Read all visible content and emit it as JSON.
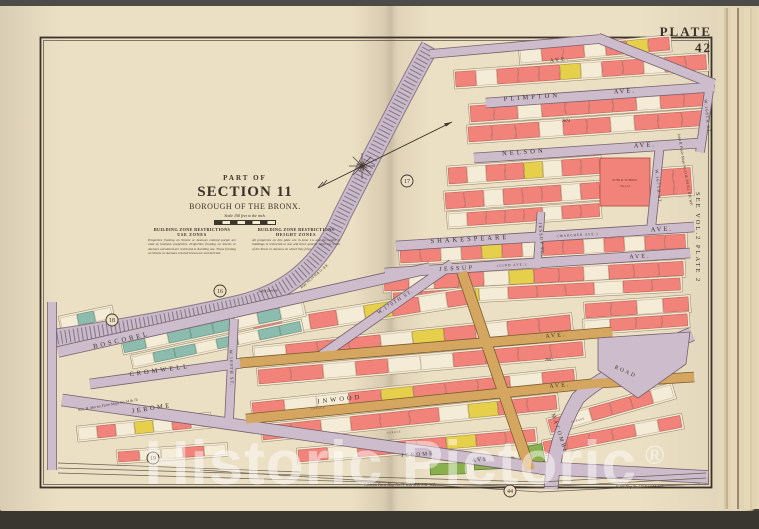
{
  "page": {
    "plate_label": "PLATE 42",
    "side_ref": "SEE VOL.2 PLATE 2",
    "title": {
      "part_of": "PART OF",
      "section": "SECTION 11",
      "borough": "BOROUGH OF THE BRONX.",
      "scale_note": "Scale 100 feet to the inch."
    },
    "zone_notes": [
      {
        "heading": "BUILDING ZONE RESTRICTIONS",
        "sub": "USE ZONES",
        "body": "Properties fronting on Streets or Avenues colored purple are used as business properties. Properties fronting on Streets or Avenues uncolored are restricted to dwelling use. Those fronting on Streets or Avenues colored brown are unrestricted."
      },
      {
        "heading": "BUILDING ZONE RESTRICTIONS",
        "sub": "HEIGHT ZONES",
        "body": "All properties on this plate are in zone 1¾ and the height of buildings is restricted to one and three quarter times the width of the Street or Avenues on which they front."
      }
    ],
    "watermark": {
      "text": "Historic Pictoric",
      "reg": "®"
    }
  },
  "colors": {
    "page": "#ebdfc4",
    "block_face": "#f2e9d3",
    "block_edge": "#8c7a60",
    "street": "#cdbccb",
    "street_edge": "#77606e",
    "tan": "#d4a660",
    "tan_edge": "#7c5c30",
    "rail": "#c9bac9",
    "rail_tie": "#857386",
    "rail_edge": "#8a7888",
    "pink": "#f2837b",
    "pink_edge": "#a84a40",
    "yellow": "#e6cf4a",
    "yellow_edge": "#8a7a28",
    "white": "#f4ecd7",
    "white_edge": "#b3a287",
    "teal": "#8cbcae",
    "teal_edge": "#44766a",
    "green": "#8ab04e",
    "green_edge": "#4c6e2a",
    "ink": "#3b3329",
    "track": "#6b5f55"
  },
  "map": {
    "frame": {
      "x": 40,
      "y": 37,
      "w": 672,
      "h": 451
    },
    "rows": [
      {
        "x": 520,
        "y": 50,
        "w": 150,
        "h": 13,
        "r": -5,
        "cs": "wppwpyp"
      },
      {
        "x": 455,
        "y": 72,
        "w": 252,
        "h": 15,
        "r": -4,
        "cs": "pwpppywppwpp"
      },
      {
        "x": 470,
        "y": 106,
        "w": 238,
        "h": 16,
        "r": -4,
        "cs": "ppwppppwpp"
      },
      {
        "x": 468,
        "y": 127,
        "w": 238,
        "h": 15,
        "r": -4,
        "cs": "pppwppwppp"
      },
      {
        "x": 448,
        "y": 168,
        "w": 152,
        "h": 16,
        "r": -4,
        "cs": "pwppywpp"
      },
      {
        "x": 445,
        "y": 193,
        "w": 155,
        "h": 16,
        "r": -4,
        "cs": "ppwpppwp"
      },
      {
        "x": 448,
        "y": 214,
        "w": 152,
        "h": 13,
        "r": -4,
        "cs": "wppppwpp"
      },
      {
        "x": 655,
        "y": 170,
        "w": 36,
        "h": 26,
        "r": -4,
        "cs": "pp"
      },
      {
        "x": 400,
        "y": 249,
        "w": 286,
        "h": 14,
        "r": -3,
        "cs": "ppwpypwppwpwpp"
      },
      {
        "x": 384,
        "y": 277,
        "w": 300,
        "h": 14,
        "r": -3,
        "cs": "pwppwyppwppp"
      },
      {
        "x": 393,
        "y": 293,
        "w": 288,
        "h": 12,
        "r": -3,
        "cs": "ppywpppwpp"
      },
      {
        "x": 254,
        "y": 323,
        "w": 222,
        "h": 15,
        "r": -9,
        "cs": "pwpwypwp"
      },
      {
        "x": 254,
        "y": 348,
        "w": 318,
        "h": 15,
        "r": -6,
        "cs": "wpppwypwpp"
      },
      {
        "x": 258,
        "y": 370,
        "w": 326,
        "h": 14,
        "r": -5,
        "cs": "ppwpwwpppp"
      },
      {
        "x": 252,
        "y": 403,
        "w": 324,
        "h": 15,
        "r": -6,
        "cs": "pwwpypppwp"
      },
      {
        "x": 262,
        "y": 426,
        "w": 296,
        "h": 14,
        "r": -6,
        "cs": "ppwpppwypp"
      },
      {
        "x": 298,
        "y": 450,
        "w": 238,
        "h": 12,
        "r": -5,
        "cs": "pwpppypp"
      },
      {
        "x": 122,
        "y": 341,
        "w": 184,
        "h": 12,
        "r": -12,
        "cs": "twtttwtw"
      },
      {
        "x": 132,
        "y": 357,
        "w": 172,
        "h": 10,
        "r": -12,
        "cs": "wttwtwtt"
      },
      {
        "x": 60,
        "y": 318,
        "w": 52,
        "h": 11,
        "r": -12,
        "cs": "wtw"
      },
      {
        "x": 78,
        "y": 428,
        "w": 132,
        "h": 12,
        "r": -6,
        "cs": "wpwywpw"
      },
      {
        "x": 118,
        "y": 452,
        "w": 108,
        "h": 10,
        "r": -4,
        "cs": "pwwpw"
      },
      {
        "x": 548,
        "y": 420,
        "w": 128,
        "h": 13,
        "r": -16,
        "cs": "pwpppw"
      },
      {
        "x": 543,
        "y": 442,
        "w": 140,
        "h": 12,
        "r": -11,
        "cs": "ppppwp"
      },
      {
        "x": 585,
        "y": 304,
        "w": 104,
        "h": 14,
        "r": -4,
        "cs": "ppwp"
      },
      {
        "x": 584,
        "y": 321,
        "w": 104,
        "h": 12,
        "r": -4,
        "cs": "wppp"
      }
    ],
    "greens": [
      {
        "x": 430,
        "y": 464,
        "w": 36,
        "h": 11,
        "r": -2
      },
      {
        "x": 474,
        "y": 459,
        "w": 40,
        "h": 11,
        "r": -3
      },
      {
        "x": 528,
        "y": 446,
        "w": 14,
        "h": 18,
        "r": -10
      }
    ],
    "school": {
      "x": 600,
      "y": 158,
      "w": 50,
      "h": 48,
      "label1": "PUBLIC SCHOOL",
      "label2": "No.114"
    },
    "rail": {
      "d": "M430,46 C400,100 365,170 342,215 C322,262 290,292 240,304 C180,318 110,330 56,338"
    },
    "plaza": "598,338 690,332 686,364 638,398 598,370",
    "streets": [
      {
        "d": "M430,54 L600,39",
        "w": 8,
        "k": "st",
        "n": "street-top-boundary"
      },
      {
        "d": "M598,38 L714,84",
        "w": 9,
        "k": "st",
        "n": "street-top-right"
      },
      {
        "d": "M486,103 L714,87",
        "w": 9,
        "k": "st",
        "n": "street-plimpton-ave"
      },
      {
        "d": "M710,84 L700,152",
        "w": 8,
        "k": "st",
        "n": "street-w168th-st"
      },
      {
        "d": "M474,158 L701,143",
        "w": 9,
        "k": "st",
        "n": "street-nelson-ave"
      },
      {
        "d": "M660,144 L651,229",
        "w": 8,
        "k": "st",
        "n": "street-w167th-st"
      },
      {
        "d": "M396,246 L694,227",
        "w": 9,
        "k": "st",
        "n": "street-shakespeare-ave"
      },
      {
        "d": "M385,273 L690,253",
        "w": 9,
        "k": "st",
        "n": "street-jessup-ave"
      },
      {
        "d": "M541,212 L537,268",
        "w": 7,
        "k": "st",
        "n": "street-jessup-pl"
      },
      {
        "d": "M322,355 L452,264",
        "w": 9,
        "k": "st",
        "n": "street-w170th-st"
      },
      {
        "d": "M58,352 L430,268",
        "w": 10,
        "k": "st",
        "n": "street-boscobel-ave"
      },
      {
        "d": "M90,384 L242,363",
        "w": 9,
        "k": "st",
        "n": "street-cromwell-ave"
      },
      {
        "d": "M234,319 L229,421",
        "w": 8,
        "k": "st",
        "n": "street-w169th-st"
      },
      {
        "d": "M52,302 L52,470",
        "w": 8,
        "k": "st",
        "n": "street-left-vertical"
      },
      {
        "d": "M62,400 L540,468",
        "w": 11,
        "k": "st",
        "n": "street-jerome-ave"
      },
      {
        "d": "M540,468 L708,477",
        "w": 12,
        "k": "st",
        "n": "street-jerome-ave-east"
      },
      {
        "d": "M692,334 C640,356 600,378 578,398 C560,428 553,458 551,489",
        "w": 13,
        "k": "st",
        "n": "street-macombs-road"
      },
      {
        "d": "M240,363 L612,332",
        "w": 9,
        "k": "tan",
        "n": "street-cromwell-ave-east"
      },
      {
        "d": "M246,419 L600,383 L694,377",
        "w": 9,
        "k": "tan",
        "n": "street-inwood-ave"
      },
      {
        "d": "M462,272 L530,470",
        "w": 10,
        "k": "tan",
        "n": "street-diagonal-tan"
      }
    ],
    "tracks": [
      "M58,463 L300,472",
      "M58,468 L540,482 L706,473",
      "M58,473 L540,487 L706,478",
      "M200,470 L540,492 L700,484"
    ],
    "labels": [
      {
        "t": "PLIMPTON",
        "x": 532,
        "y": 99,
        "r": -4,
        "s": 6.5,
        "sp": 3
      },
      {
        "t": "AVE.",
        "x": 625,
        "y": 93,
        "r": -4,
        "s": 6.5,
        "sp": 2
      },
      {
        "t": "NELSON",
        "x": 524,
        "y": 154,
        "r": -4,
        "s": 6.5,
        "sp": 3
      },
      {
        "t": "AVE.",
        "x": 645,
        "y": 147,
        "r": -4,
        "s": 6.5,
        "sp": 2
      },
      {
        "t": "SHAKESPEARE",
        "x": 470,
        "y": 241,
        "r": -3,
        "s": 6.5,
        "sp": 3
      },
      {
        "t": "(MARCHER AVE.)",
        "x": 578,
        "y": 236,
        "r": -3,
        "s": 3.4,
        "sp": 1
      },
      {
        "t": "AVE.",
        "x": 662,
        "y": 231,
        "r": -3,
        "s": 6.5,
        "sp": 2
      },
      {
        "t": "JESSUP",
        "x": 457,
        "y": 270,
        "r": -3,
        "s": 6,
        "sp": 2.5
      },
      {
        "t": "(LIND AVE.)",
        "x": 512,
        "y": 266,
        "r": -3,
        "s": 3.4,
        "sp": 1
      },
      {
        "t": "AVE.",
        "x": 640,
        "y": 258,
        "r": -3,
        "s": 6,
        "sp": 2
      },
      {
        "t": "JESSUP PL.",
        "x": 540,
        "y": 240,
        "r": 86,
        "s": 4.6,
        "sp": 1.2
      },
      {
        "t": "W.170TH ST.",
        "x": 396,
        "y": 303,
        "r": -33,
        "s": 5.2,
        "sp": 1.2
      },
      {
        "t": "BOSCOBEL",
        "x": 122,
        "y": 342,
        "r": -13,
        "s": 6.5,
        "sp": 3
      },
      {
        "t": "CROMWELL",
        "x": 160,
        "y": 372,
        "r": -8,
        "s": 6.5,
        "sp": 3
      },
      {
        "t": "AVE.",
        "x": 556,
        "y": 337,
        "r": -5,
        "s": 6,
        "sp": 2
      },
      {
        "t": "W.169TH ST.",
        "x": 230,
        "y": 368,
        "r": 88,
        "s": 4.6,
        "sp": 1
      },
      {
        "t": "INWOOD",
        "x": 340,
        "y": 401,
        "r": -6,
        "s": 6.5,
        "sp": 3
      },
      {
        "t": "AVE.",
        "x": 560,
        "y": 387,
        "r": -5,
        "s": 6,
        "sp": 2
      },
      {
        "t": "JEROME",
        "x": 152,
        "y": 410,
        "r": -9,
        "s": 6.5,
        "sp": 2.5
      },
      {
        "t": "JEROME",
        "x": 418,
        "y": 456,
        "r": -4,
        "s": 5.5,
        "sp": 2
      },
      {
        "t": "AVE.",
        "x": 482,
        "y": 461,
        "r": -4,
        "s": 5.5,
        "sp": 2
      },
      {
        "t": "MACOMBS",
        "x": 558,
        "y": 434,
        "r": 72,
        "s": 5.5,
        "sp": 2
      },
      {
        "t": "ROAD",
        "x": 625,
        "y": 373,
        "r": 24,
        "s": 5.5,
        "sp": 2
      },
      {
        "t": "W.168TH ST.",
        "x": 706,
        "y": 117,
        "r": 84,
        "s": 4.4,
        "sp": 1
      },
      {
        "t": "W.167TH ST.",
        "x": 657,
        "y": 187,
        "r": 84,
        "s": 4.4,
        "sp": 1
      },
      {
        "t": "AVE.",
        "x": 560,
        "y": 61,
        "r": -7,
        "s": 5.5,
        "sp": 2
      }
    ],
    "block_numbers": [
      {
        "t": "2674",
        "x": 566,
        "y": 122
      },
      {
        "t": "2667",
        "x": 549,
        "y": 361
      }
    ],
    "garages": [
      {
        "t": "GARAGE",
        "x": 318,
        "y": 409,
        "r": -6
      },
      {
        "t": "GARAGE",
        "x": 394,
        "y": 433,
        "r": -6
      },
      {
        "t": "GARAGE",
        "x": 578,
        "y": 421,
        "r": -15
      }
    ],
    "notes": [
      {
        "t": "John  Devoe",
        "x": 268,
        "y": 292,
        "r": -3,
        "s": 4.2
      },
      {
        "t": "Rept. No.14  W.& O. R.R.",
        "x": 315,
        "y": 277,
        "r": -41,
        "s": 3.6
      },
      {
        "t": "Wm. H. Morris Farm  Maps No.14 & 74",
        "x": 108,
        "y": 406,
        "r": -10,
        "s": 3.8
      },
      {
        "t": "John R. Poole   Maps No.41 & 391   B.I. F.M. W.F.",
        "x": 684,
        "y": 170,
        "r": 80,
        "s": 3.8
      },
      {
        "t": "Gibbons  Farm    Map No.71   W.& M.B.  S.M.   W.P.",
        "x": 400,
        "y": 486,
        "r": 0,
        "s": 3.8
      },
      {
        "t": "E.106   Map No.129   B.S.F.M.   W.F.",
        "x": 640,
        "y": 488,
        "r": 0,
        "s": 3.6
      }
    ],
    "circles": [
      {
        "n": "17",
        "x": 407,
        "y": 181
      },
      {
        "n": "16",
        "x": 220,
        "y": 291
      },
      {
        "n": "18",
        "x": 112,
        "y": 320
      },
      {
        "n": "19",
        "x": 153,
        "y": 458
      },
      {
        "n": "44",
        "x": 510,
        "y": 491
      }
    ],
    "compass": {
      "cx": 362,
      "cy": 166,
      "x1": 318,
      "y1": 188,
      "x2": 452,
      "y2": 122
    }
  }
}
